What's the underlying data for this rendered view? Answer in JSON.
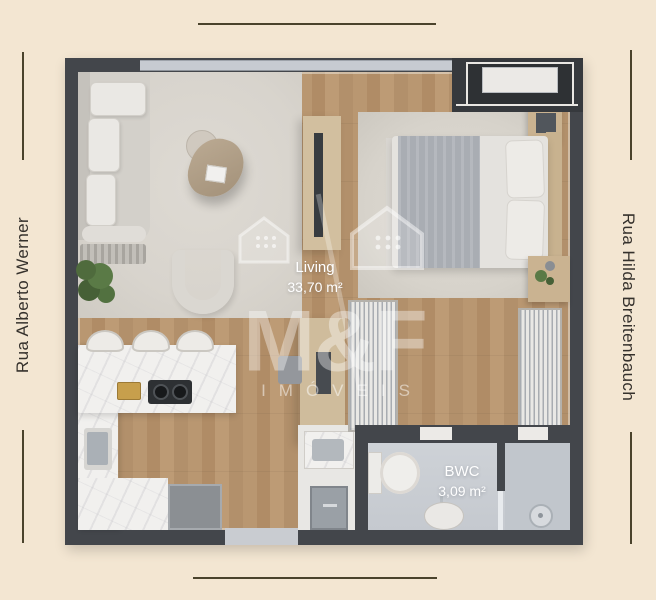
{
  "streets": {
    "left": "Rua Alberto Werner",
    "right": "Rua Hilda Breitenbauch"
  },
  "rooms": {
    "living": {
      "name": "Living",
      "area": "33,70 m²"
    },
    "bwc": {
      "name": "BWC",
      "area": "3,09 m²"
    }
  },
  "watermark": {
    "brand": "M&F",
    "subtitle": "IMÓVEIS"
  },
  "palette": {
    "bg": "#f3e6d2",
    "frame_line": "#4a432c",
    "street_text": "#35312c",
    "wall": "#43464b",
    "wood": "#b5946f",
    "rug": "#d8d4cd",
    "bedroom_rug": "#d7d3cb",
    "counter": "#f1f0ee",
    "tile": "#cbcfd4",
    "tan": "#d2bf9f",
    "plant": "#527140",
    "label_text": "#ffffff"
  }
}
